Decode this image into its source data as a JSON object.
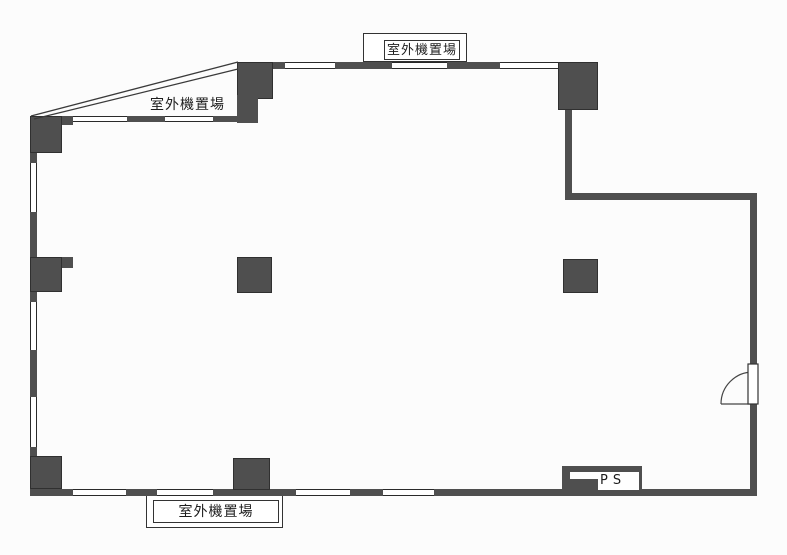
{
  "labels": {
    "outdoor_unit_top": "室外機置場",
    "outdoor_unit_left": "室外機置場",
    "outdoor_unit_bottom": "室外機置場",
    "pipe_shaft": "PS"
  },
  "colors": {
    "wall_fill": "#4f4f4f",
    "line_color": "#2a2a2a",
    "background": "#fcfcfc"
  }
}
